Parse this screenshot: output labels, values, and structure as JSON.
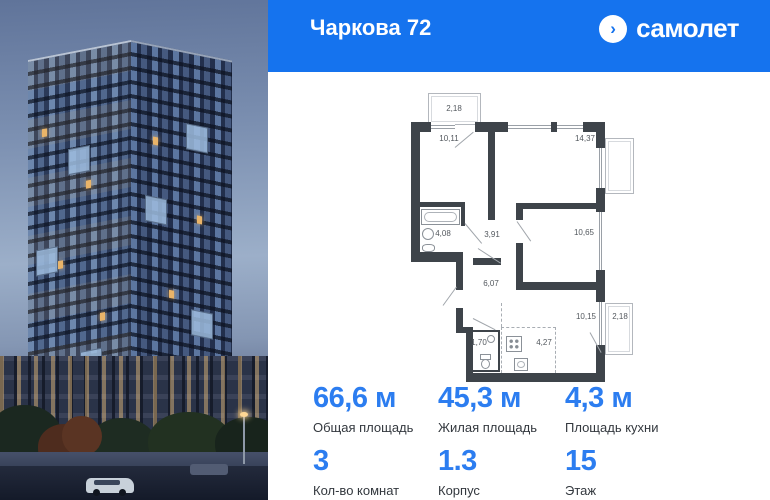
{
  "header": {
    "title": "Чаркова 72",
    "brand": "самолет",
    "brand_icon": "›"
  },
  "floor_plan": {
    "rooms": [
      {
        "name": "balcony-top",
        "area": "2,18"
      },
      {
        "name": "room-top-left",
        "area": "10,11"
      },
      {
        "name": "room-top-right",
        "area": "14,37"
      },
      {
        "name": "bathroom",
        "area": "4,08"
      },
      {
        "name": "hallway",
        "area": "3,91"
      },
      {
        "name": "room-right",
        "area": "10,65"
      },
      {
        "name": "corridor",
        "area": "6,07"
      },
      {
        "name": "room-bottom-right",
        "area": "10,15"
      },
      {
        "name": "balcony-right",
        "area": "2,18"
      },
      {
        "name": "wc",
        "area": "1,70"
      },
      {
        "name": "kitchen",
        "area": "4,27"
      }
    ]
  },
  "stats": {
    "row1": [
      {
        "value": "66,6 м",
        "label": "Общая площадь"
      },
      {
        "value": "45,3 м",
        "label": "Жилая площадь"
      },
      {
        "value": "4,3 м",
        "label": "Площадь кухни"
      }
    ],
    "row2": [
      {
        "value": "3",
        "label": "Кол-во комнат"
      },
      {
        "value": "1.3",
        "label": "Корпус"
      },
      {
        "value": "15",
        "label": "Этаж"
      }
    ]
  },
  "colors": {
    "header_blue": "#1573EE",
    "accent_blue": "#2C7DF0",
    "wall_dark": "#3E444A"
  }
}
